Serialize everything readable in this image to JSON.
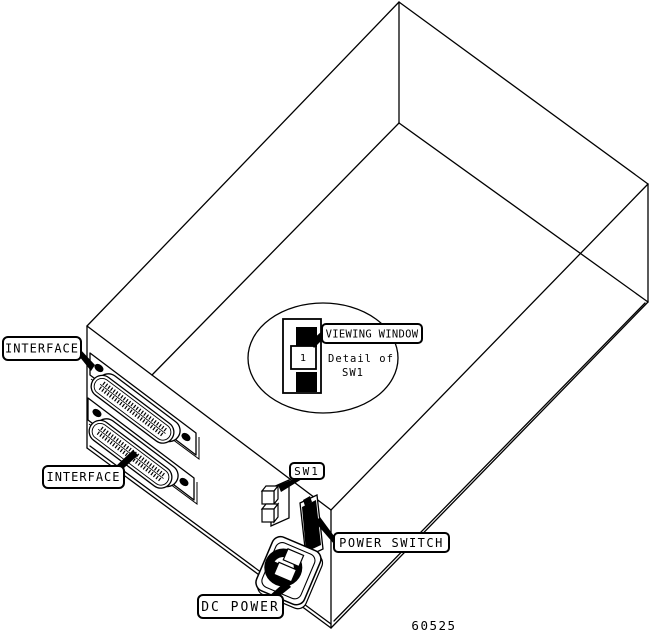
{
  "figure": {
    "number": "60525",
    "background_color": "#ffffff",
    "line_color": "#000000"
  },
  "callouts": {
    "interface_top": {
      "label": "INTERFACE"
    },
    "interface_bottom": {
      "label": "INTERFACE"
    },
    "viewing_window": {
      "label": "VIEWING WINDOW"
    },
    "sw1": {
      "label": "SW1"
    },
    "power_switch": {
      "label": "POWER SWITCH"
    },
    "dc_power": {
      "label": "DC POWER"
    }
  },
  "detail_inset": {
    "caption_line1": "Detail of",
    "caption_line2": "SW1",
    "window_digit": "1"
  }
}
